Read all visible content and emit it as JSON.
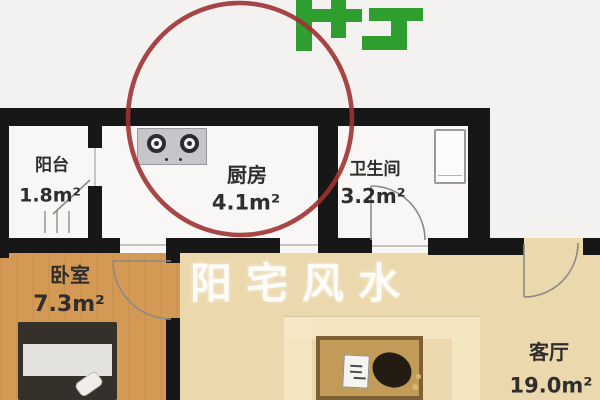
{
  "watermark": "阳宅风水",
  "logo": {
    "name": "green-logo-partial",
    "color": "#2e9e2e"
  },
  "annotation": {
    "shape": "hand-drawn circle",
    "highlight_color": "#9e3132",
    "target": "kitchen"
  },
  "rooms": {
    "balcony": {
      "name": "阳台",
      "area": "1.8m²"
    },
    "kitchen": {
      "name": "厨房",
      "area": "4.1m²"
    },
    "bathroom": {
      "name": "卫生间",
      "area": "3.2m²"
    },
    "bedroom": {
      "name": "卧室",
      "area": "7.3m²"
    },
    "living_room": {
      "name": "客厅",
      "area": "19.0m²"
    }
  },
  "colors": {
    "wall": "#171717",
    "room_floor_white": "#f8f7f5",
    "bedroom_floor": "#d49a55",
    "living_floor": "#ebd8ad",
    "background": "#f3f2f0",
    "watermark_text": "#ffffff"
  }
}
